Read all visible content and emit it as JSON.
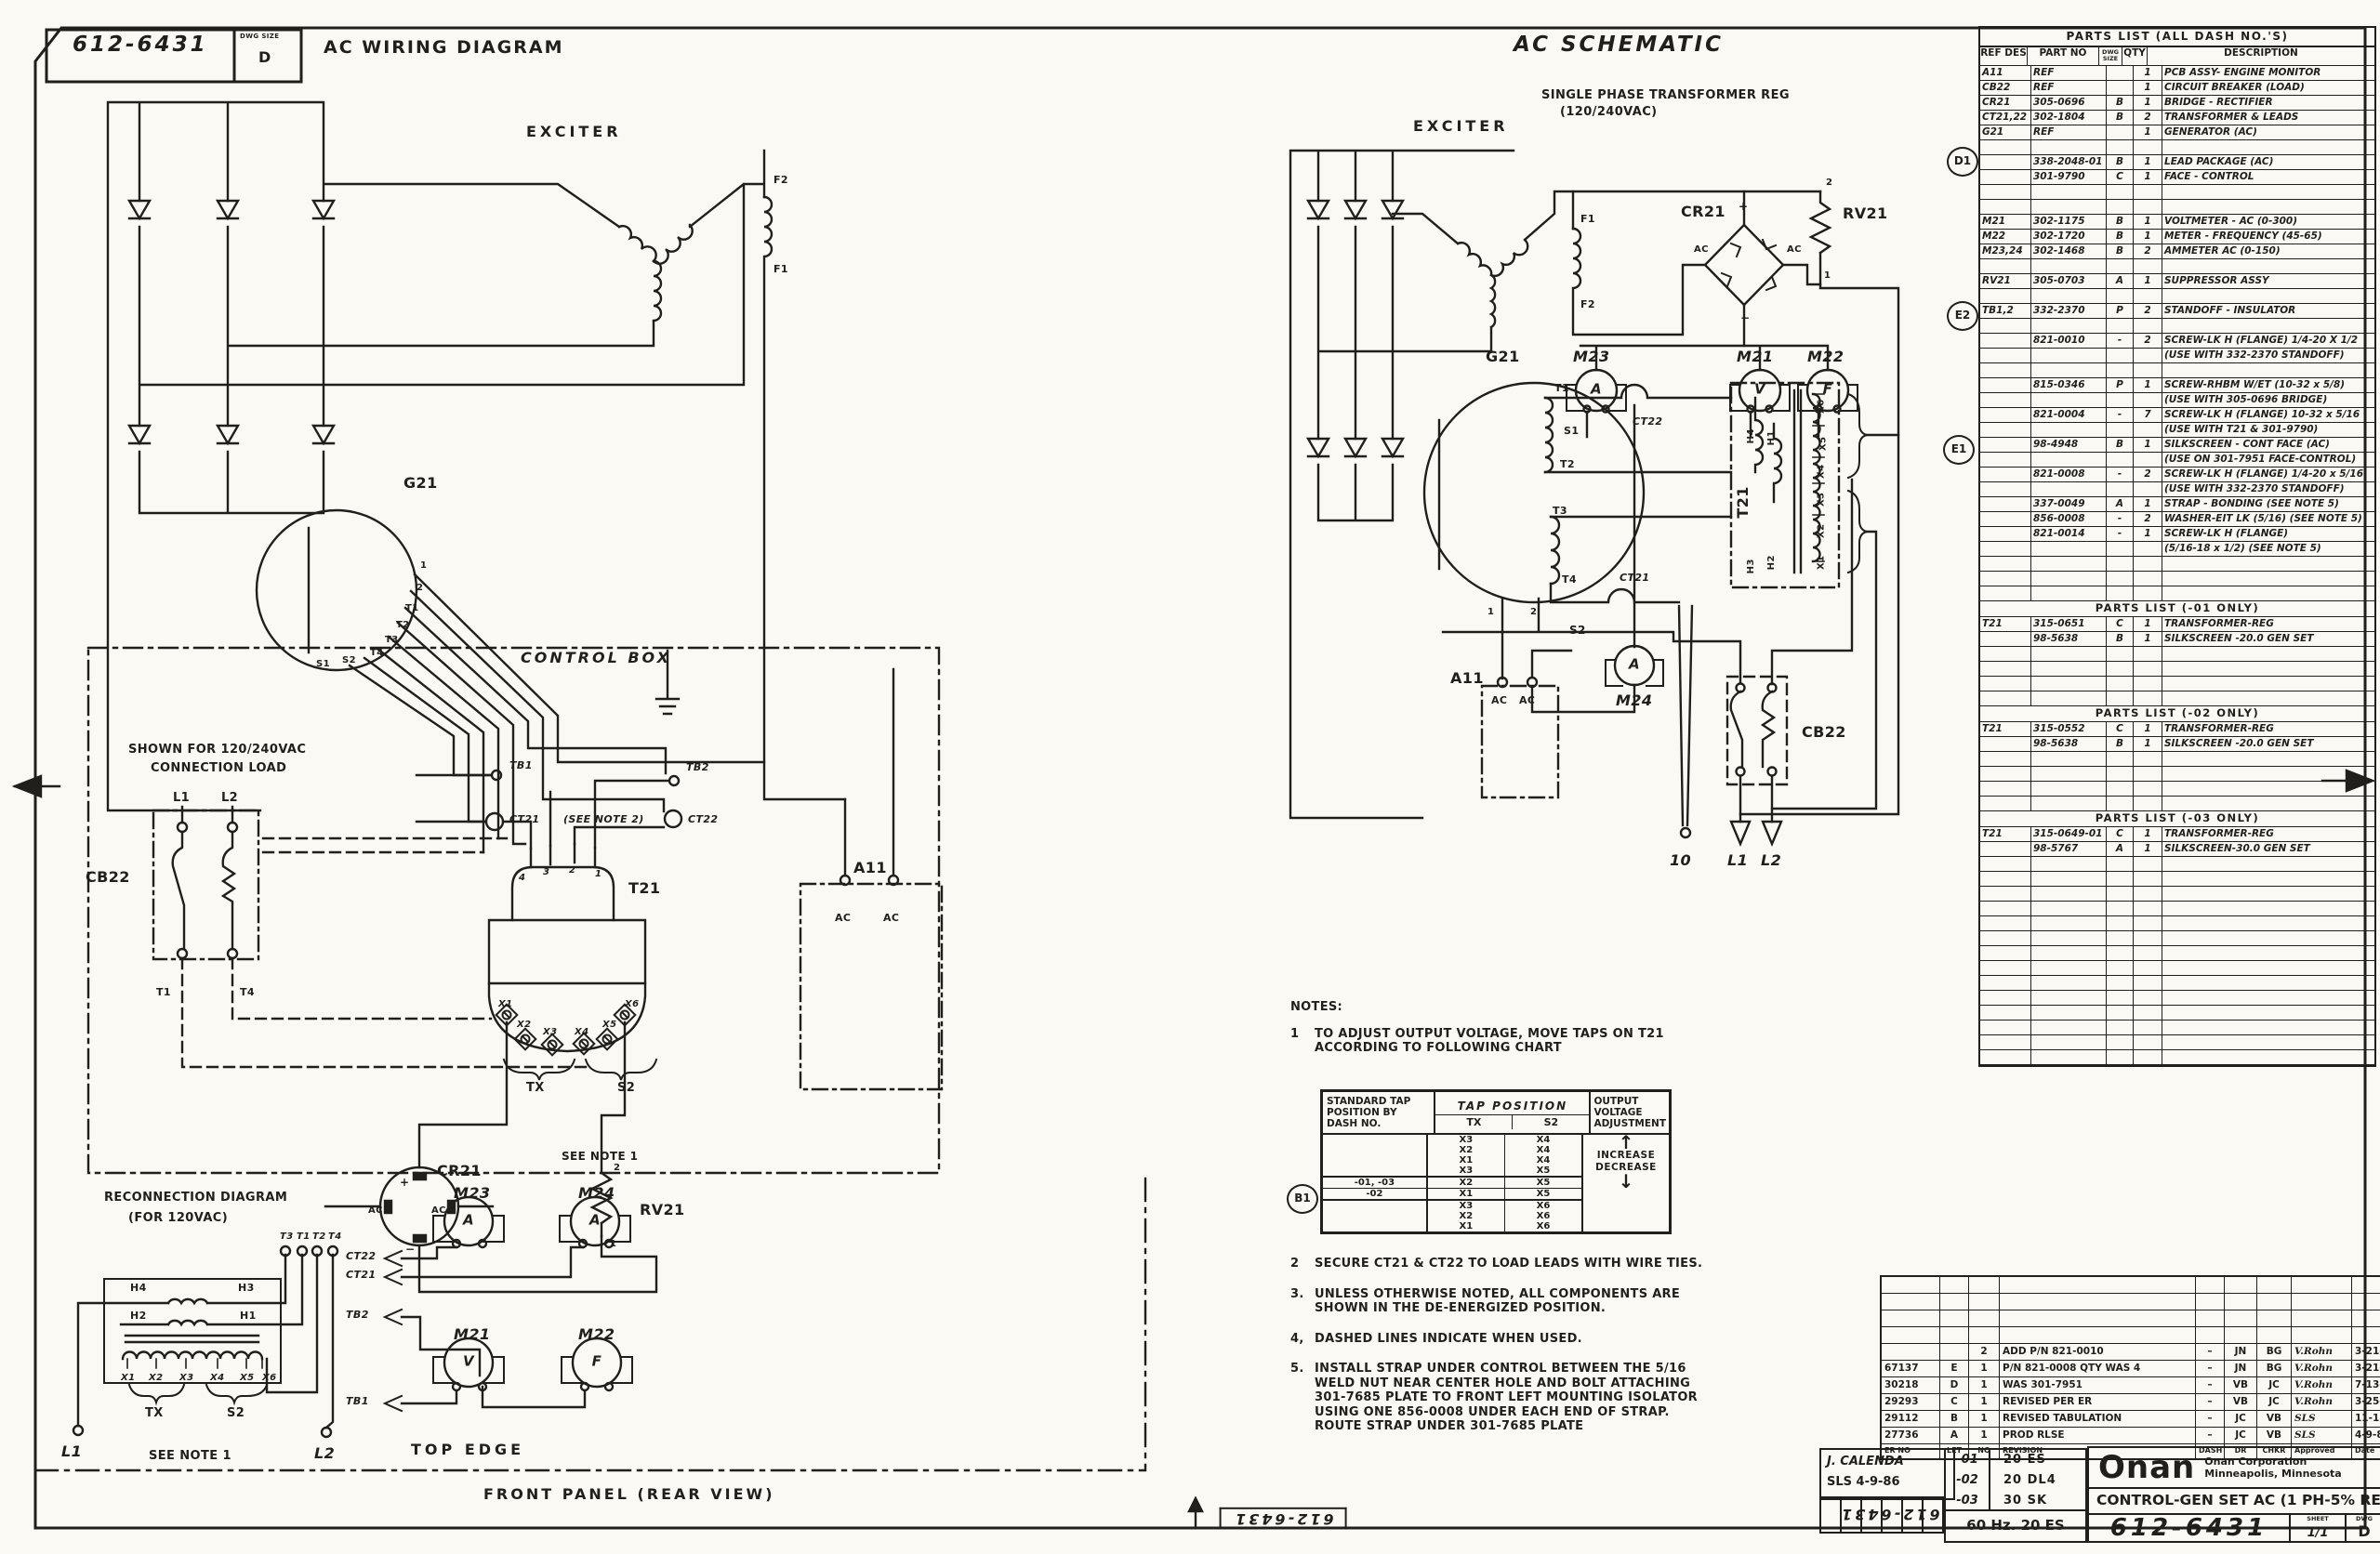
{
  "sheet": {
    "dwg_no": "612-6431",
    "dwg_size_caption": "DWG SIZE",
    "dwg_size": "D",
    "flip_no_center": "612-6431",
    "flip_no_right": "612-6431"
  },
  "wiring": {
    "title": "AC WIRING DIAGRAM",
    "exciter": "EXCITER",
    "f2": "F2",
    "f1": "F1",
    "g21": "G21",
    "lead_1": "1",
    "lead_2": "2",
    "lead_t1": "T1",
    "lead_t2": "T2",
    "lead_t3": "T3",
    "lead_t4": "T4",
    "lead_s2": "S2",
    "lead_s1": "S1",
    "control_box": "CONTROL BOX",
    "shown_for": "SHOWN FOR 120/240VAC",
    "connection_load": "CONNECTION LOAD",
    "l1": "L1",
    "l2": "L2",
    "cb22": "CB22",
    "t1": "T1",
    "t4": "T4",
    "tb1": "TB1",
    "tb2": "TB2",
    "ct21": "CT21",
    "see_note2": "(SEE NOTE 2)",
    "ct22": "CT22",
    "t21": "T21",
    "pin4": "4",
    "pin3": "3",
    "pin2": "2",
    "pin1": "1",
    "x1": "X1",
    "x2": "X2",
    "x3": "X3",
    "x4": "X4",
    "x5": "X5",
    "x6": "X6",
    "tx": "TX",
    "s2": "S2",
    "see_note1": "SEE NOTE 1",
    "cr21": "CR21",
    "plus": "+",
    "minus": "−",
    "ac_l": "AC",
    "ac_r": "AC",
    "rv21": "RV21",
    "rv_2": "2",
    "rv_1": "1",
    "a11": "A11",
    "a11_ac1": "AC",
    "a11_ac2": "AC",
    "recon1": "RECONNECTION DIAGRAM",
    "recon2": "(FOR 120VAC)",
    "rt3": "T3",
    "rt1": "T1",
    "rt2": "T2",
    "rt4": "T4",
    "h4": "H4",
    "h3": "H3",
    "h2": "H2",
    "h1": "H1",
    "rx1": "X1",
    "rx2": "X2",
    "rx3": "X3",
    "rx4": "X4",
    "rx5": "X5",
    "rx6": "X6",
    "rtx": "TX",
    "rs2": "S2",
    "rl1": "L1",
    "rl2": "L2",
    "rnote": "SEE NOTE 1",
    "m23": "M23",
    "m24": "M24",
    "m21": "M21",
    "m22": "M22",
    "m23_letter": "A",
    "m24_letter": "A",
    "m21_letter": "V",
    "m22_letter": "F",
    "fct22": "CT22",
    "fct21": "CT21",
    "ftb2": "TB2",
    "ftb1": "TB1",
    "top_edge": "TOP EDGE",
    "front_panel": "FRONT PANEL (REAR VIEW)"
  },
  "schematic": {
    "title": "AC SCHEMATIC",
    "sub1": "SINGLE PHASE TRANSFORMER REG",
    "sub2": "(120/240VAC)",
    "exciter": "EXCITER",
    "f1": "F1",
    "f2": "F2",
    "cr21": "CR21",
    "plus": "+",
    "minus": "−",
    "ac_l": "AC",
    "ac_r": "AC",
    "rv21": "RV21",
    "rv_2": "2",
    "rv_1": "1",
    "m23": "M23",
    "m21": "M21",
    "m22": "M22",
    "m24": "M24",
    "m23_letter": "A",
    "m21_letter": "V",
    "m22_letter": "F",
    "m24_letter": "A",
    "g21": "G21",
    "t1": "T1",
    "s1": "S1",
    "t2": "T2",
    "t3": "T3",
    "t4": "T4",
    "ct22": "CT22",
    "ct21": "CT21",
    "n1": "1",
    "n2": "2",
    "s2": "S2",
    "t21": "T21",
    "h4": "H4",
    "h1": "H1",
    "h3": "H3",
    "h2": "H2",
    "x6": "X6",
    "x5": "X5",
    "x4": "X4",
    "x3": "X3",
    "x2": "X2",
    "x1": "X1",
    "a11": "A11",
    "a11_ac1": "AC",
    "a11_ac2": "AC",
    "cb22": "CB22",
    "out10": "10",
    "l1": "L1",
    "l2": "L2"
  },
  "refs": {
    "d1": "D1",
    "e2": "E2",
    "e1": "E1",
    "b1": "B1"
  },
  "parts_headers": {
    "ref": "REF DES",
    "part": "PART NO",
    "dwg": "DWG SIZE",
    "qty": "QTY",
    "desc": "DESCRIPTION"
  },
  "parts_all": {
    "title": "PARTS LIST (ALL DASH NO.'S)",
    "rows": [
      {
        "ref": "A11",
        "part": "REF",
        "dwg": "",
        "qty": "1",
        "desc": "PCB ASSY- ENGINE MONITOR"
      },
      {
        "ref": "CB22",
        "part": "REF",
        "dwg": "",
        "qty": "1",
        "desc": "CIRCUIT BREAKER (LOAD)"
      },
      {
        "ref": "CR21",
        "part": "305-0696",
        "dwg": "B",
        "qty": "1",
        "desc": "BRIDGE - RECTIFIER"
      },
      {
        "ref": "CT21,22",
        "part": "302-1804",
        "dwg": "B",
        "qty": "2",
        "desc": "TRANSFORMER & LEADS"
      },
      {
        "ref": "G21",
        "part": "REF",
        "dwg": "",
        "qty": "1",
        "desc": "GENERATOR (AC)"
      },
      {},
      {
        "ref": "",
        "part": "338-2048-01",
        "dwg": "B",
        "qty": "1",
        "desc": "LEAD PACKAGE (AC)"
      },
      {
        "ref": "",
        "part": "301-9790",
        "dwg": "C",
        "qty": "1",
        "desc": "FACE - CONTROL"
      },
      {},
      {},
      {
        "ref": "M21",
        "part": "302-1175",
        "dwg": "B",
        "qty": "1",
        "desc": "VOLTMETER - AC (0-300)"
      },
      {
        "ref": "M22",
        "part": "302-1720",
        "dwg": "B",
        "qty": "1",
        "desc": "METER - FREQUENCY (45-65)"
      },
      {
        "ref": "M23,24",
        "part": "302-1468",
        "dwg": "B",
        "qty": "2",
        "desc": "AMMETER AC (0-150)"
      },
      {},
      {
        "ref": "RV21",
        "part": "305-0703",
        "dwg": "A",
        "qty": "1",
        "desc": "SUPPRESSOR ASSY"
      },
      {},
      {
        "ref": "TB1,2",
        "part": "332-2370",
        "dwg": "P",
        "qty": "2",
        "desc": "STANDOFF - INSULATOR"
      },
      {},
      {
        "ref": "",
        "part": "821-0010",
        "dwg": "-",
        "qty": "2",
        "desc": "SCREW-LK H (FLANGE) 1/4-20 X 1/2"
      },
      {
        "desc": "(USE WITH 332-2370 STANDOFF)"
      },
      {},
      {
        "ref": "",
        "part": "815-0346",
        "dwg": "P",
        "qty": "1",
        "desc": "SCREW-RHBM W/ET (10-32 x 5/8)"
      },
      {
        "desc": "(USE WITH 305-0696 BRIDGE)"
      },
      {
        "ref": "",
        "part": "821-0004",
        "dwg": "-",
        "qty": "7",
        "desc": "SCREW-LK H (FLANGE) 10-32 x 5/16"
      },
      {
        "desc": "(USE WITH T21 & 301-9790)"
      },
      {
        "ref": "",
        "part": "98-4948",
        "dwg": "B",
        "qty": "1",
        "desc": "SILKSCREEN - CONT FACE (AC)"
      },
      {
        "desc": "(USE ON 301-7951  FACE-CONTROL)"
      },
      {
        "ref": "",
        "part": "821-0008",
        "dwg": "-",
        "qty": "2",
        "desc": "SCREW-LK H (FLANGE) 1/4-20 x 5/16"
      },
      {
        "desc": "(USE WITH 332-2370 STANDOFF)"
      },
      {
        "ref": "",
        "part": "337-0049",
        "dwg": "A",
        "qty": "1",
        "desc": "STRAP - BONDING (SEE NOTE 5)"
      },
      {
        "ref": "",
        "part": "856-0008",
        "dwg": "-",
        "qty": "2",
        "desc": "WASHER-EIT LK (5/16) (SEE NOTE 5)"
      },
      {
        "ref": "",
        "part": "821-0014",
        "dwg": "-",
        "qty": "1",
        "desc": "SCREW-LK H (FLANGE)"
      },
      {
        "desc": "(5/16-18 x 1/2) (SEE NOTE 5)"
      },
      {},
      {},
      {}
    ]
  },
  "parts_01": {
    "title": "PARTS LIST (-01 ONLY)",
    "rows": [
      {
        "ref": "T21",
        "part": "315-0651",
        "dwg": "C",
        "qty": "1",
        "desc": "TRANSFORMER-REG"
      },
      {
        "ref": "",
        "part": "98-5638",
        "dwg": "B",
        "qty": "1",
        "desc": "SILKSCREEN -20.0 GEN SET"
      },
      {},
      {},
      {},
      {}
    ]
  },
  "parts_02": {
    "title": "PARTS LIST (-02 ONLY)",
    "rows": [
      {
        "ref": "T21",
        "part": "315-0552",
        "dwg": "C",
        "qty": "1",
        "desc": "TRANSFORMER-REG"
      },
      {
        "ref": "",
        "part": "98-5638",
        "dwg": "B",
        "qty": "1",
        "desc": "SILKSCREEN -20.0 GEN SET"
      },
      {},
      {},
      {},
      {}
    ]
  },
  "parts_03": {
    "title": "PARTS LIST (-03 ONLY)",
    "rows": [
      {
        "ref": "T21",
        "part": "315-0649-01",
        "dwg": "C",
        "qty": "1",
        "desc": "TRANSFORMER-REG"
      },
      {
        "ref": "",
        "part": "98-5767",
        "dwg": "A",
        "qty": "1",
        "desc": "SILKSCREEN-30.0 GEN SET"
      },
      {},
      {},
      {},
      {},
      {},
      {},
      {},
      {},
      {},
      {},
      {},
      {},
      {},
      {}
    ]
  },
  "notes": {
    "heading": "NOTES:",
    "n1_num": "1",
    "n1_text": "TO ADJUST OUTPUT VOLTAGE, MOVE TAPS ON T21 ACCORDING TO FOLLOWING CHART",
    "items": [
      {
        "num": "2",
        "text": "SECURE CT21 & CT22 TO LOAD LEADS WITH WIRE TIES."
      },
      {
        "num": "3.",
        "text": "UNLESS OTHERWISE NOTED, ALL COMPONENTS ARE SHOWN IN THE DE-ENERGIZED POSITION."
      },
      {
        "num": "4,",
        "text": "DASHED LINES INDICATE WHEN USED."
      },
      {
        "num": "5.",
        "text": "INSTALL STRAP UNDER CONTROL BETWEEN THE 5/16 WELD NUT NEAR CENTER HOLE AND BOLT ATTACHING 301-7685 PLATE TO FRONT LEFT MOUNTING ISOLATOR USING ONE 856-0008 UNDER EACH END OF STRAP. ROUTE STRAP UNDER 301-7685 PLATE"
      }
    ]
  },
  "chart": {
    "h_dash": "STANDARD TAP POSITION BY DASH NO.",
    "h_tap": "TAP POSITION",
    "h_tx": "TX",
    "h_s2": "S2",
    "h_out": "OUTPUT VOLTAGE ADJUSTMENT",
    "increase": "INCREASE",
    "decrease": "DECREASE",
    "up_arrow": "↑",
    "down_arrow": "↓",
    "rows": [
      {
        "dash": "",
        "tx": "X3",
        "s2": "X4"
      },
      {
        "dash": "",
        "tx": "X2",
        "s2": "X4"
      },
      {
        "dash": "",
        "tx": "X1",
        "s2": "X4"
      },
      {
        "dash": "",
        "tx": "X3",
        "s2": "X5"
      },
      {
        "dash": "-01, -03",
        "tx": "X2",
        "s2": "X5"
      },
      {
        "dash": "-02",
        "tx": "X1",
        "s2": "X5"
      },
      {
        "dash": "",
        "tx": "X3",
        "s2": "X6"
      },
      {
        "dash": "",
        "tx": "X2",
        "s2": "X6"
      },
      {
        "dash": "",
        "tx": "X1",
        "s2": "X6"
      }
    ]
  },
  "revisions": {
    "headers": {
      "er": "ER NO",
      "let": "LET",
      "no": "NO",
      "desc": "REVISION",
      "dash": "DASH",
      "dr": "DR",
      "chk": "CHKR",
      "app": "Approved",
      "date": "Date"
    },
    "rows": [
      {},
      {},
      {},
      {},
      {
        "er": "",
        "let": "",
        "no": "2",
        "desc": "ADD P/N 821-0010",
        "dash": "–",
        "dr": "JN",
        "chk": "BG",
        "app": "V.Rohn",
        "date": "3-21-94"
      },
      {
        "er": "67137",
        "let": "E",
        "no": "1",
        "desc": "P/N 821-0008 QTY WAS 4",
        "dash": "–",
        "dr": "JN",
        "chk": "BG",
        "app": "V.Rohn",
        "date": "3-21-94"
      },
      {
        "er": "30218",
        "let": "D",
        "no": "1",
        "desc": "WAS 301-7951",
        "dash": "–",
        "dr": "VB",
        "chk": "JC",
        "app": "V.Rohn",
        "date": "7-13-87"
      },
      {
        "er": "29293",
        "let": "C",
        "no": "1",
        "desc": "REVISED PER ER",
        "dash": "–",
        "dr": "VB",
        "chk": "JC",
        "app": "V.Rohn",
        "date": "3-25-87"
      },
      {
        "er": "29112",
        "let": "B",
        "no": "1",
        "desc": "REVISED TABULATION",
        "dash": "–",
        "dr": "JC",
        "chk": "VB",
        "app": "SLS",
        "date": "11-18-86"
      },
      {
        "er": "27736",
        "let": "A",
        "no": "1",
        "desc": "PROD RLSE",
        "dash": "–",
        "dr": "JC",
        "chk": "VB",
        "app": "SLS",
        "date": "4-9-86"
      }
    ]
  },
  "titleblock": {
    "drafter": "J. CALENDA",
    "checker": "SLS 4-9-86",
    "dashes": [
      {
        "dash": "-01",
        "model": "20 ES"
      },
      {
        "dash": "-02",
        "model": "20 DL4"
      },
      {
        "dash": "-03",
        "model": "30 SK"
      }
    ],
    "freq": "60 Hz. 20 ES",
    "brand": "Onan",
    "corp1": "Onan Corporation",
    "corp2": "Minneapolis, Minnesota",
    "title": "CONTROL-GEN SET AC (1 PH-5% REG)",
    "number": "612-6431",
    "sheet_caption": "SHEET",
    "sheet": "1/1",
    "size_caption": "DWG",
    "size": "D"
  }
}
